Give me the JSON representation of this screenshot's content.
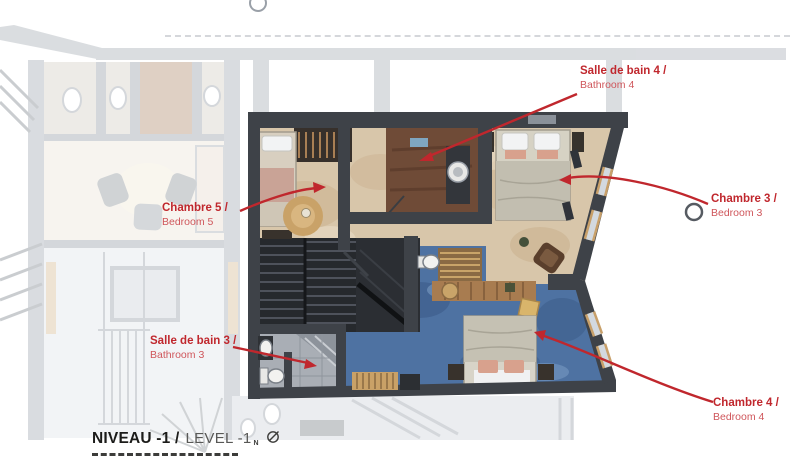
{
  "title": {
    "fr": "NIVEAU -1 /",
    "en": "LEVEL -1",
    "north": "N"
  },
  "room_labels": [
    {
      "id": "bedroom5",
      "fr": "Chambre 5 /",
      "en": "Bedroom 5"
    },
    {
      "id": "bathroom4",
      "fr": "Salle de bain 4 /",
      "en": "Bathroom 4"
    },
    {
      "id": "bedroom3",
      "fr": "Chambre 3 /",
      "en": "Bedroom 3"
    },
    {
      "id": "bathroom3",
      "fr": "Salle de bain 3 /",
      "en": "Bathroom 3"
    },
    {
      "id": "bedroom4",
      "fr": "Chambre 4 /",
      "en": "Bedroom 4"
    }
  ],
  "colors": {
    "accent": "#c0272d",
    "accent-light": "#cf565b",
    "wall": "#3e4248",
    "floor-beige": "#d8c6aa",
    "carpet-blue": "#4e72a2",
    "wood-brown": "#6f4b37",
    "tile-gray": "#a9aeb5"
  }
}
